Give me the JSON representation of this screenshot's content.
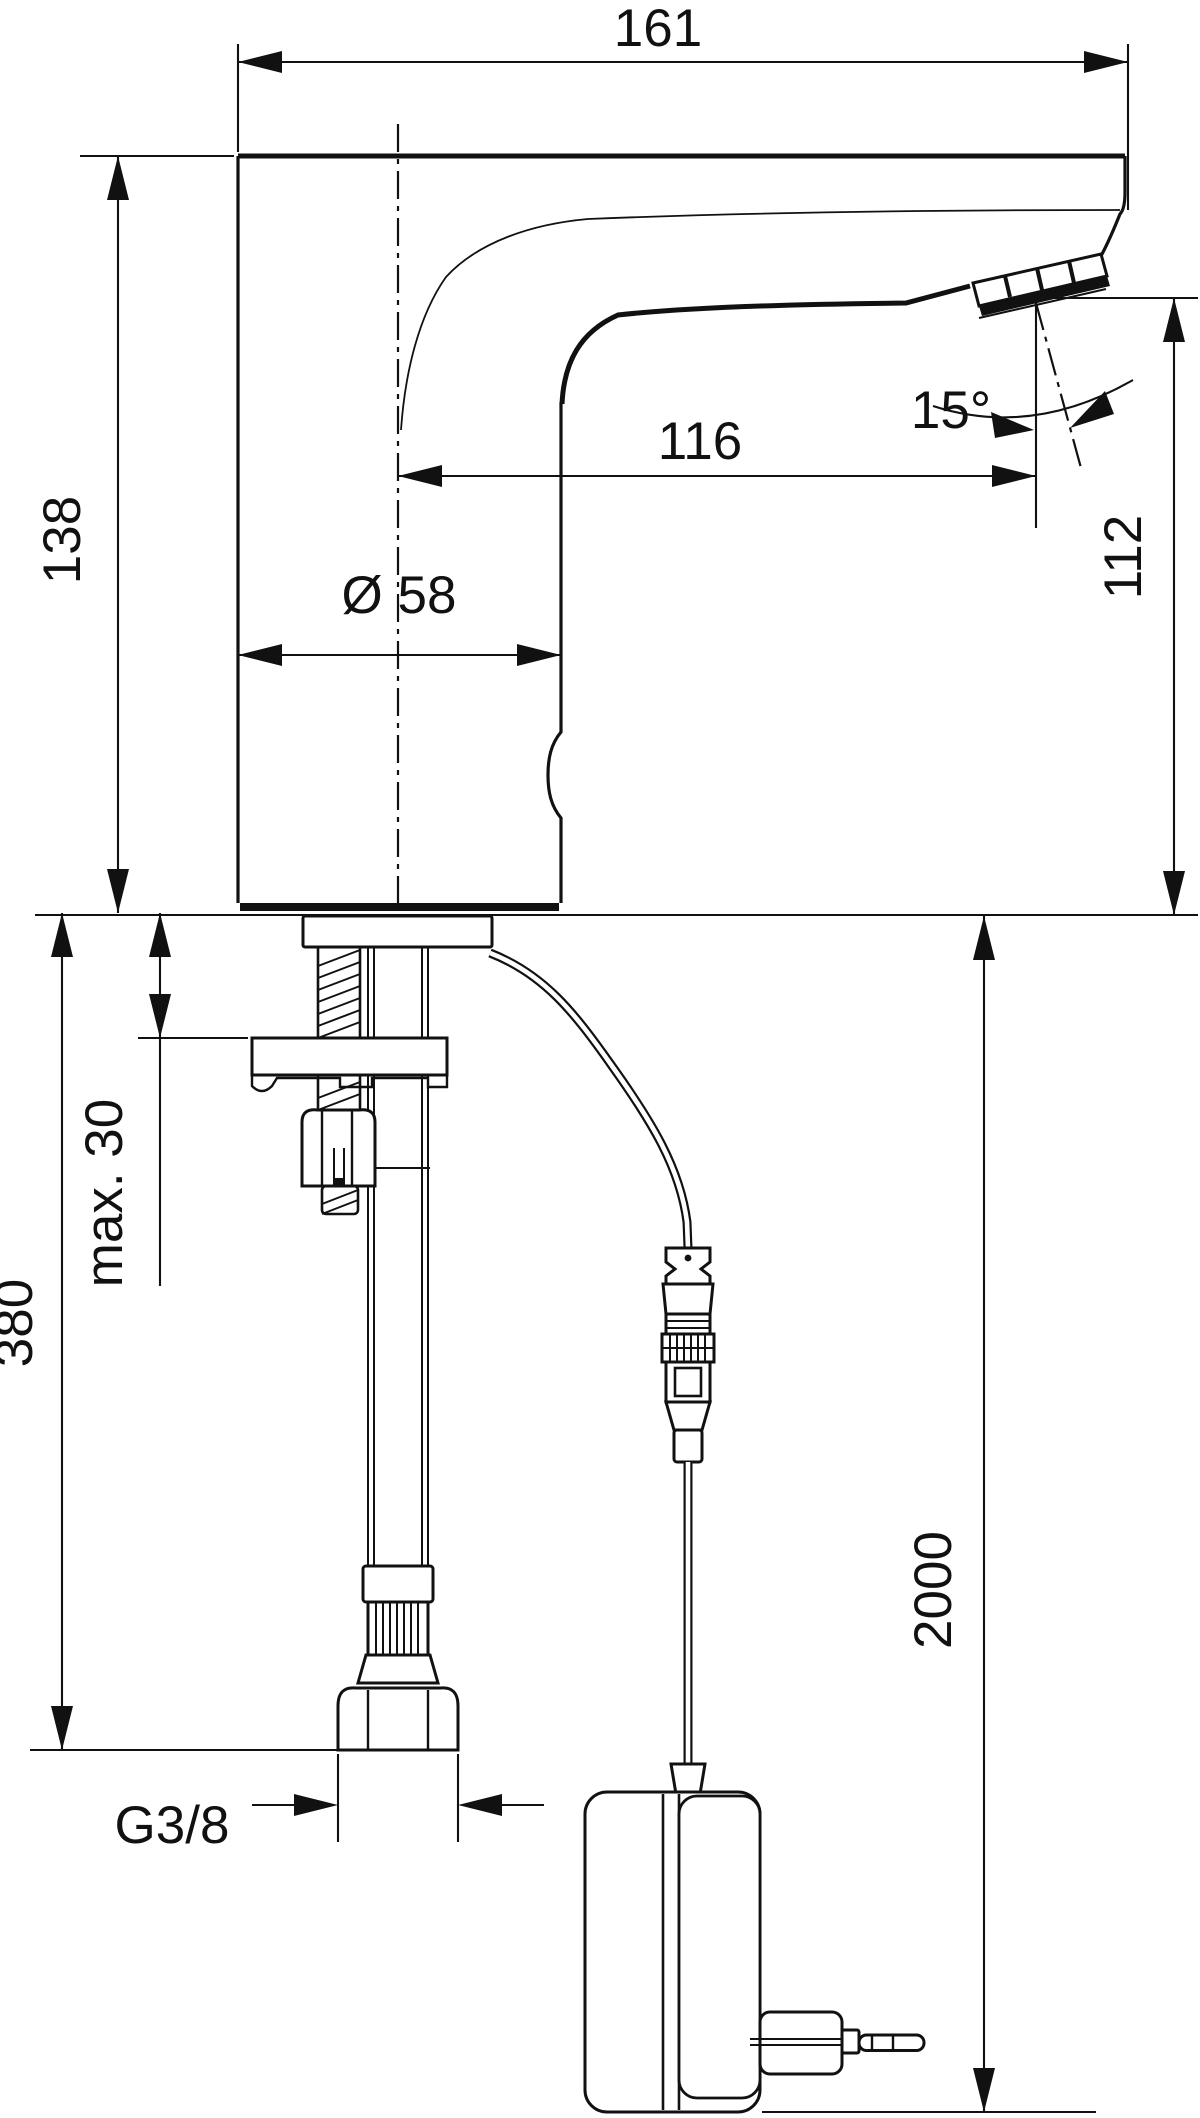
{
  "drawing": {
    "title": "Sensor basin mixer - dimensional side view with supply hose, mains cable and plug-in power supply",
    "units": "mm",
    "colors": {
      "line": "#111111",
      "background": "#ffffff"
    },
    "labels": {
      "overall_depth": "161",
      "spout_angle": "15°",
      "spout_reach": "116",
      "height_to_top": "138",
      "outlet_height": "112",
      "body_diameter": "Ø 58",
      "max_deck_thickness": "max. 30",
      "supply_hose_drop": "380",
      "power_cable_length": "2000",
      "supply_thread": "G3/8"
    }
  }
}
